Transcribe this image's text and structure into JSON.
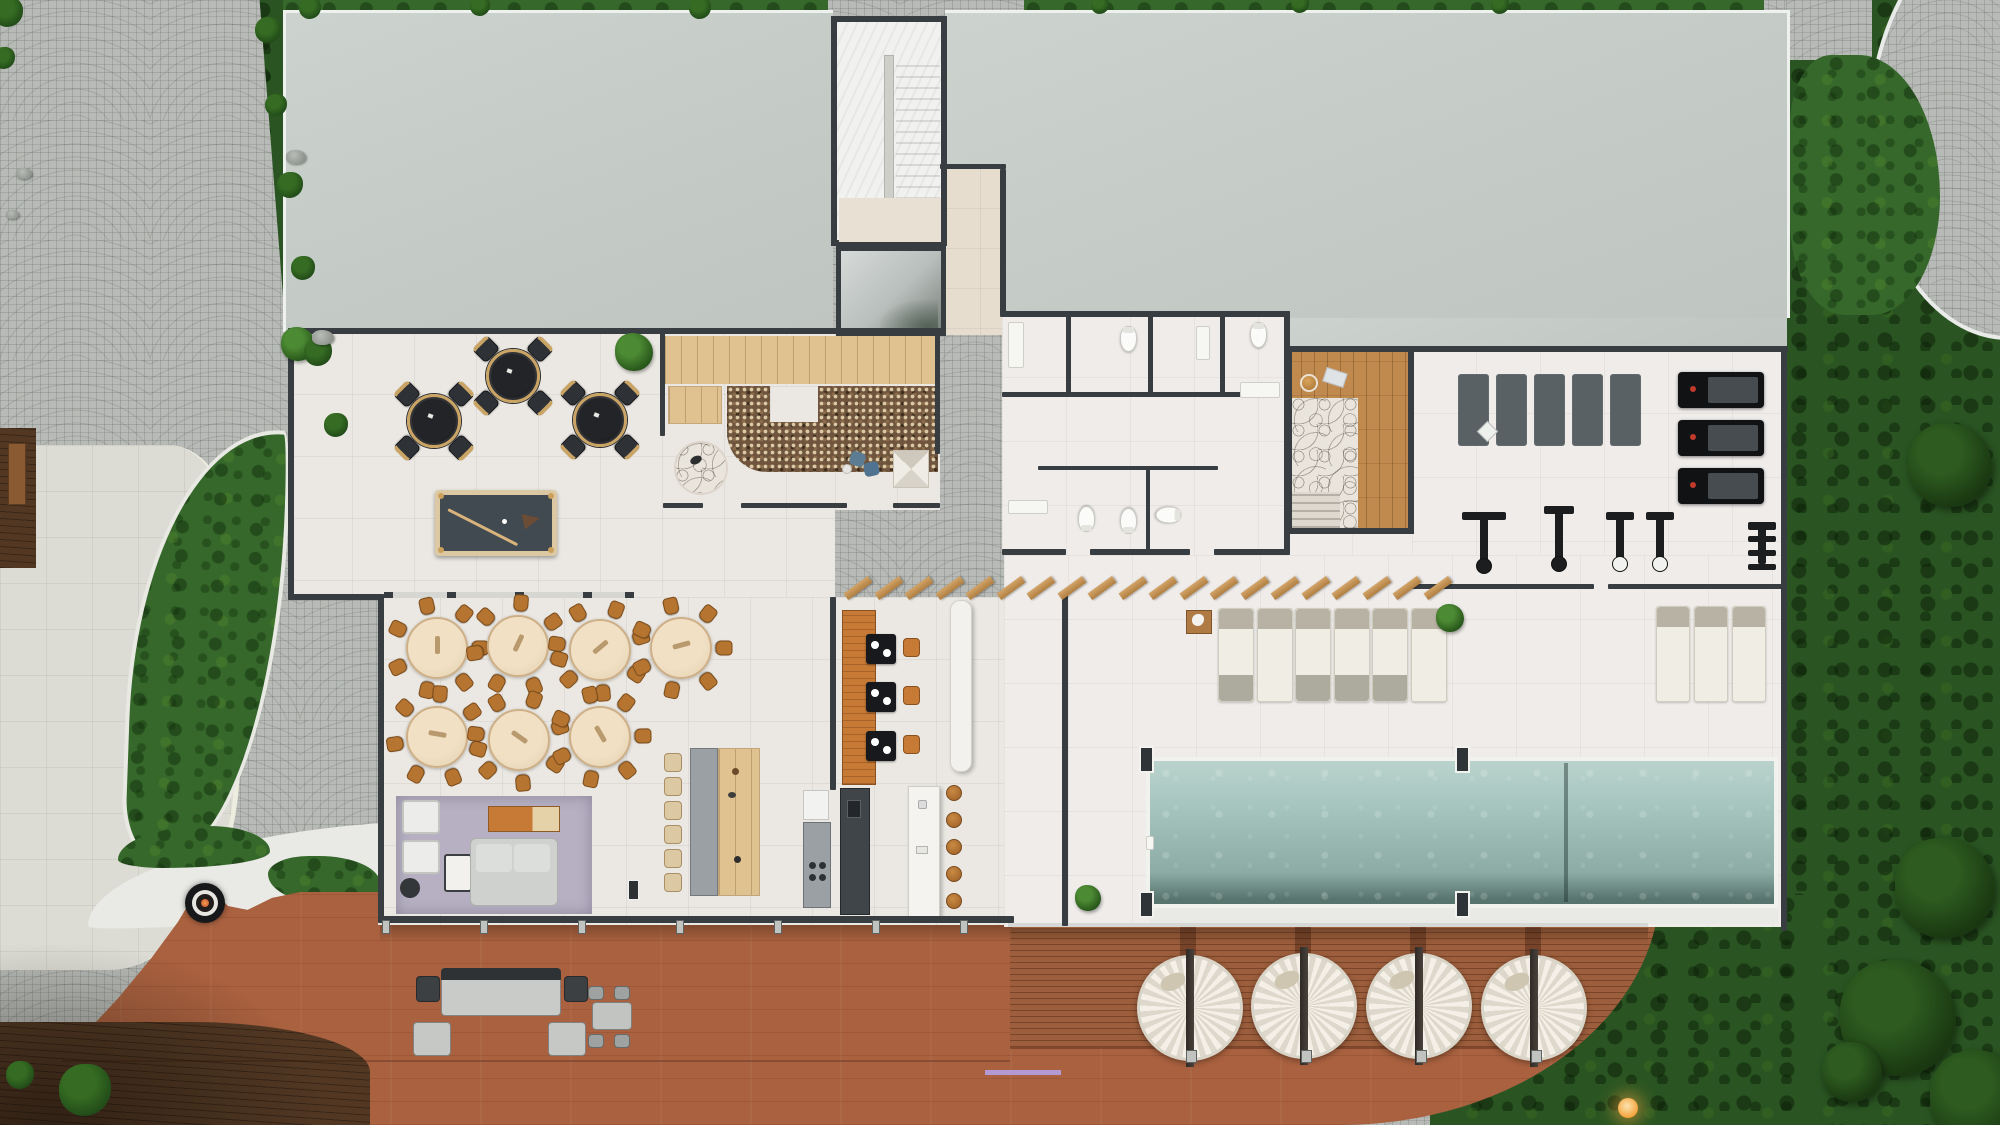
{
  "scene": {
    "description": "Top-down photoreal 3D render of a clubhouse amenity floor plan with game lounge, lobby garden, dining hall, kitchen and bar, restrooms, sauna, gym, indoor lap pool, sun loungers, pergola, and a large curved outdoor wood deck with round daybeds and a fire pit",
    "view": "top-down",
    "no_visible_text": true
  },
  "palette": {
    "roof": "#c7cec9",
    "cobblestone": "#b7bab6",
    "grass": "#35682a",
    "grass_dark": "#2a5522",
    "floor": "#ebe8e3",
    "wall": "#383d42",
    "deck_slatted": "#9c5e3c",
    "deck_smooth": "#a9613f",
    "pool_water": "#a7c6bf",
    "dining_chair": "#b5742f",
    "dining_table": "#ecdabd",
    "pergola_wood": "#c49257",
    "rug_lavender": "#b6b0c2",
    "booth_orange": "#c77a35",
    "billiard_felt": "#414951",
    "fire_pit_ember": "#c8452c",
    "lamp_glow": "#f5a43c"
  },
  "areas": [
    {
      "id": "game-lounge"
    },
    {
      "id": "lobby-garden"
    },
    {
      "id": "entry-stair-tower"
    },
    {
      "id": "restrooms"
    },
    {
      "id": "sauna-spa"
    },
    {
      "id": "gym"
    },
    {
      "id": "dining-hall"
    },
    {
      "id": "kitchen"
    },
    {
      "id": "bar"
    },
    {
      "id": "tv-lounge"
    },
    {
      "id": "indoor-pool"
    },
    {
      "id": "sun-lounger-terrace"
    },
    {
      "id": "pergola"
    },
    {
      "id": "outdoor-deck"
    },
    {
      "id": "fire-pit-terrace"
    },
    {
      "id": "plaza"
    },
    {
      "id": "lawn"
    },
    {
      "id": "cobblestone-drive"
    }
  ],
  "walls": [
    [
      288,
      328,
      654,
      6
    ],
    [
      288,
      328,
      6,
      272
    ],
    [
      288,
      594,
      96,
      6
    ],
    [
      378,
      594,
      6,
      328
    ],
    [
      378,
      916,
      636,
      7
    ],
    [
      660,
      332,
      5,
      104
    ],
    [
      663,
      503,
      40,
      5
    ],
    [
      741,
      503,
      106,
      5
    ],
    [
      893,
      503,
      47,
      5
    ],
    [
      935,
      332,
      5,
      122
    ],
    [
      940,
      164,
      66,
      5
    ],
    [
      1000,
      169,
      6,
      148
    ],
    [
      1002,
      311,
      288,
      6
    ],
    [
      1284,
      311,
      6,
      240
    ],
    [
      1066,
      311,
      5,
      85
    ],
    [
      1148,
      311,
      5,
      85
    ],
    [
      1220,
      311,
      5,
      85
    ],
    [
      1002,
      392,
      242,
      5
    ],
    [
      1038,
      466,
      180,
      4
    ],
    [
      1146,
      466,
      4,
      87
    ],
    [
      1002,
      549,
      64,
      6
    ],
    [
      1090,
      549,
      100,
      6
    ],
    [
      1214,
      549,
      76,
      6
    ],
    [
      1288,
      346,
      500,
      6
    ],
    [
      1781,
      346,
      6,
      585
    ],
    [
      1412,
      584,
      182,
      5
    ],
    [
      1608,
      584,
      175,
      5
    ],
    [
      1062,
      592,
      6,
      334
    ],
    [
      830,
      597,
      6,
      193
    ]
  ],
  "furniture": {
    "bistro_tables": {
      "positions": [
        [
          434,
          421
        ],
        [
          513,
          376
        ],
        [
          600,
          420
        ]
      ],
      "diameter": 54,
      "chair_angles": [
        45,
        135,
        225,
        315
      ],
      "chair_radius": 38
    },
    "billiards_table": {
      "x": 435,
      "y": 490,
      "w": 122,
      "h": 66
    },
    "dining_tables": {
      "positions": [
        [
          437,
          648
        ],
        [
          518,
          646
        ],
        [
          600,
          650
        ],
        [
          681,
          648
        ],
        [
          437,
          737
        ],
        [
          519,
          740
        ],
        [
          600,
          737
        ]
      ],
      "diameter": 62,
      "chairs_per_table": 7,
      "chair_radius": 43
    },
    "communal_chairs": {
      "x": 664,
      "y0": 753,
      "step": 24,
      "count": 6
    },
    "booth": {
      "tables": [
        [
          866,
          634
        ],
        [
          866,
          682
        ],
        [
          866,
          731
        ]
      ],
      "chairs": [
        [
          903,
          638
        ],
        [
          903,
          686
        ],
        [
          903,
          735
        ]
      ]
    },
    "bar_stools": {
      "x": 946,
      "ys": [
        793,
        820,
        847,
        874,
        901
      ],
      "r": 8
    },
    "sun_loungers": {
      "rows": [
        {
          "x0": 1218,
          "step": 38.5,
          "count": 6,
          "y": 608,
          "w": 36,
          "h": 94
        },
        {
          "x0": 1656,
          "step": 38,
          "count": 3,
          "y": 606,
          "w": 34,
          "h": 96
        }
      ]
    },
    "pergola_slats": {
      "x0": 843,
      "step": 30.5,
      "count": 20,
      "y": 584,
      "w": 30,
      "h": 8,
      "angle": -36
    },
    "round_daybeds": {
      "positions": [
        [
          1190,
          1008
        ],
        [
          1304,
          1006
        ],
        [
          1419,
          1006
        ],
        [
          1534,
          1008
        ]
      ],
      "radius": 53
    },
    "daybed_posts": {
      "xs": [
        1186,
        1301,
        1416,
        1531
      ],
      "y": 1050
    },
    "deck_posts": {
      "xs": [
        382,
        480,
        578,
        676,
        774,
        872,
        960
      ],
      "y": 920
    },
    "pool": {
      "x": 1150,
      "y": 761,
      "w": 624,
      "h": 143,
      "divider_x": 1564
    },
    "pool_pillars": [
      [
        1139,
        746
      ],
      [
        1455,
        746
      ],
      [
        1139,
        891
      ],
      [
        1455,
        891
      ]
    ],
    "gym": {
      "mats": {
        "x0": 1458,
        "step": 38,
        "count": 5,
        "y": 374,
        "w": 31,
        "h": 72
      },
      "treadmills": {
        "x": 1678,
        "ys": [
          372,
          420,
          468
        ],
        "w": 86,
        "h": 36
      },
      "machines": [
        {
          "x": 1462,
          "y": 512,
          "w": 44,
          "h": 64,
          "type": "cable"
        },
        {
          "x": 1544,
          "y": 506,
          "w": 30,
          "h": 68,
          "type": "bench"
        },
        {
          "x": 1606,
          "y": 512,
          "w": 28,
          "h": 62,
          "type": "seated"
        },
        {
          "x": 1646,
          "y": 512,
          "w": 28,
          "h": 62,
          "type": "seated"
        },
        {
          "x": 1748,
          "y": 522,
          "w": 28,
          "h": 56,
          "type": "rack"
        }
      ],
      "sign": {
        "x": 1480,
        "y": 424
      }
    },
    "toilets": [
      {
        "x": 1120,
        "y": 326,
        "rot": 0
      },
      {
        "x": 1250,
        "y": 322,
        "rot": 0
      },
      {
        "x": 1078,
        "y": 506,
        "rot": 180
      },
      {
        "x": 1120,
        "y": 508,
        "rot": 180
      },
      {
        "x": 1160,
        "y": 502,
        "rot": 90
      }
    ],
    "fixtures": [
      [
        1008,
        322,
        16,
        46
      ],
      [
        1240,
        382,
        40,
        16
      ],
      [
        1008,
        500,
        40,
        14
      ],
      [
        1196,
        326,
        14,
        34
      ],
      [
        1146,
        836,
        8,
        14
      ]
    ],
    "fire_pit": {
      "x": 205,
      "y": 903
    },
    "deck_lamp": {
      "x": 1628,
      "y": 1108,
      "color": "#f5a43c"
    }
  },
  "vegetation": {
    "plants": [
      {
        "x": 298,
        "y": 344,
        "r": 17
      },
      {
        "x": 634,
        "y": 352,
        "r": 19
      },
      {
        "x": 1450,
        "y": 618,
        "r": 14
      },
      {
        "x": 1088,
        "y": 898,
        "r": 13
      }
    ],
    "bushes": [
      {
        "x": 268,
        "y": 30,
        "r": 13
      },
      {
        "x": 276,
        "y": 105,
        "r": 11
      },
      {
        "x": 290,
        "y": 185,
        "r": 13
      },
      {
        "x": 303,
        "y": 268,
        "r": 12
      },
      {
        "x": 318,
        "y": 352,
        "r": 14
      },
      {
        "x": 336,
        "y": 425,
        "r": 12
      },
      {
        "x": 8,
        "y": 12,
        "r": 15
      },
      {
        "x": 4,
        "y": 58,
        "r": 11
      },
      {
        "x": 310,
        "y": 8,
        "r": 11
      },
      {
        "x": 480,
        "y": 6,
        "r": 10
      },
      {
        "x": 700,
        "y": 8,
        "r": 11
      },
      {
        "x": 1100,
        "y": 5,
        "r": 9
      },
      {
        "x": 1300,
        "y": 4,
        "r": 9
      },
      {
        "x": 1500,
        "y": 5,
        "r": 9
      },
      {
        "x": 85,
        "y": 1090,
        "r": 26
      },
      {
        "x": 20,
        "y": 1075,
        "r": 14
      }
    ],
    "rocks": [
      {
        "x": 286,
        "y": 150,
        "w": 20,
        "h": 14
      },
      {
        "x": 312,
        "y": 330,
        "w": 22,
        "h": 15
      },
      {
        "x": 16,
        "y": 168,
        "w": 16,
        "h": 11
      },
      {
        "x": 6,
        "y": 210,
        "w": 13,
        "h": 9
      }
    ],
    "trees": [
      {
        "x": 1950,
        "y": 465,
        "r": 42
      },
      {
        "x": 1945,
        "y": 888,
        "r": 50
      },
      {
        "x": 1898,
        "y": 1018,
        "r": 58
      },
      {
        "x": 1978,
        "y": 1098,
        "r": 48
      },
      {
        "x": 1852,
        "y": 1072,
        "r": 30
      }
    ]
  }
}
